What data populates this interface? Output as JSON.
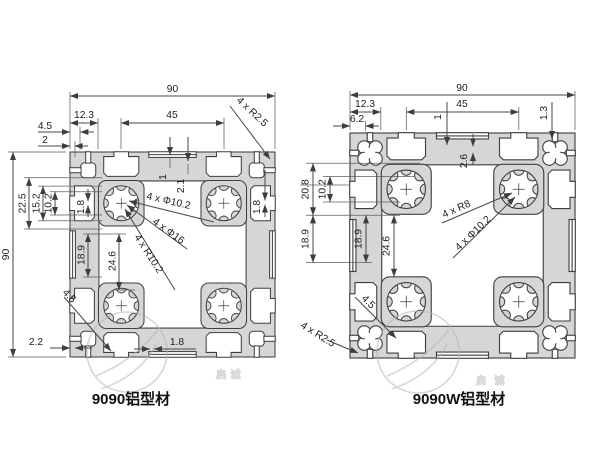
{
  "captions": {
    "left": "9090铝型材",
    "right": "9090W铝型材"
  },
  "watermark": {
    "logo": "q-circle-logo",
    "text": "启诚"
  },
  "left": {
    "name": "9090铝型材",
    "dims": {
      "w90": "90",
      "h90": "90",
      "d123": "12.3",
      "d45top": "45",
      "r25": "4 x R2.5",
      "d45corner": "4.5",
      "d2": "2",
      "d225": "22.5",
      "d152": "15.2",
      "d102": "10.2",
      "d18left": "1.8",
      "d1": "1",
      "d21": "2.1",
      "d18right": "1.8",
      "phi102": "4 x Φ10.2",
      "phi16": "4 x Φ16",
      "r102": "4 x R10.2",
      "d189": "18.9",
      "d246": "24.6",
      "d45slot": "4.5",
      "d22": "2.2",
      "d18bottom": "1.8"
    }
  },
  "right": {
    "name": "9090W铝型材",
    "dims": {
      "w90": "90",
      "d123": "12.3",
      "d45top": "45",
      "d62": "6.2",
      "d13": "1.3",
      "d1": "1",
      "d26": "2.6",
      "d208": "20.8",
      "d102": "10.2",
      "d189outer": "18.9",
      "d189inner": "18.9",
      "d246": "24.6",
      "r8": "4 x R8",
      "phi102": "4 x Φ10.2",
      "r25": "4 x R2.5",
      "d45slot": "4.5"
    }
  }
}
